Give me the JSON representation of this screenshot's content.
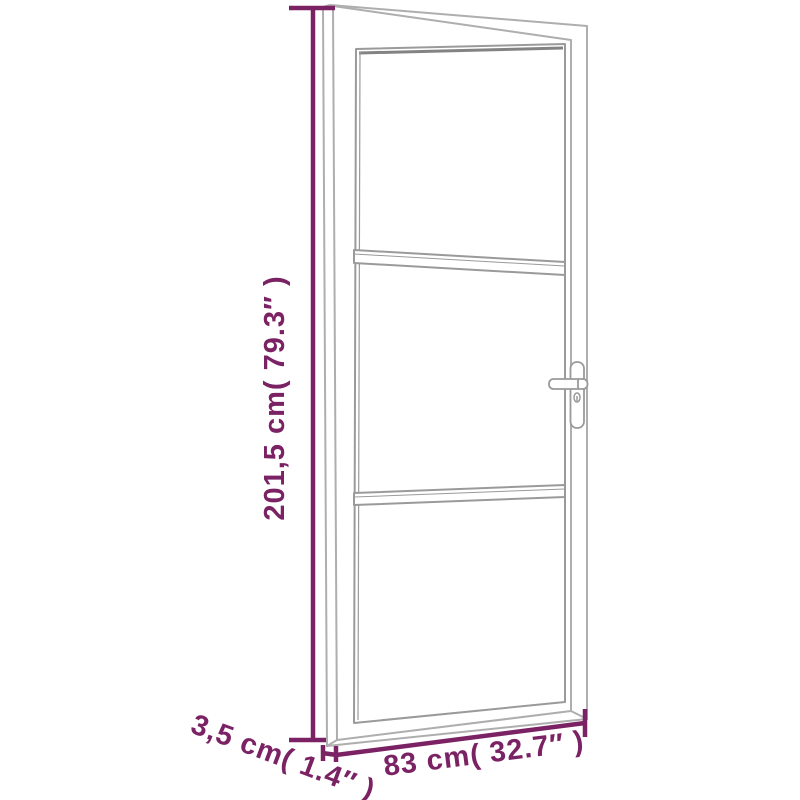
{
  "colors": {
    "dimension": "#7b2264",
    "door_line": "#aeaeae",
    "glass_line": "#9a9a9a",
    "rebate_line": "#838383",
    "background": "#ffffff"
  },
  "dimensions": {
    "height_label": "201,5 cm( 79.3″ )",
    "width_label": "83 cm( 32.7″ )",
    "depth_label": "3,5 cm( 1.4″ )"
  }
}
